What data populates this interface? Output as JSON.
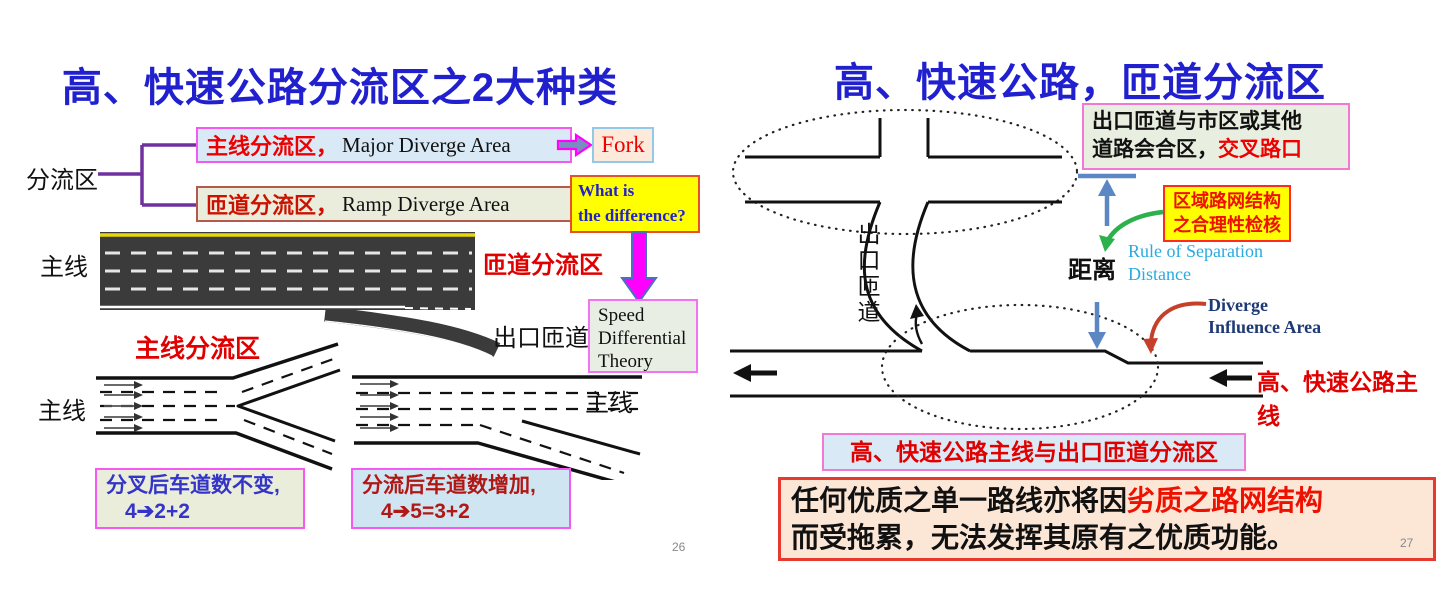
{
  "palette": {
    "title_blue": "#2020cf",
    "red_text": "#ee0000",
    "dark_red_text": "#b01815",
    "magenta_border": "#f459f4",
    "steel_blue_arrow": "#5b87c5",
    "green_arrow": "#2eb14d",
    "red_arrow": "#c5402b",
    "road_dark": "#3b3b3b",
    "yellow_box": "#ffff00"
  },
  "left_slide": {
    "title": "高、快速公路分流区之2大种类",
    "page_number": "26",
    "tree": {
      "root_label": "分流区",
      "major_cn": "主线分流区，",
      "major_en": "Major Diverge Area",
      "ramp_cn": "匝道分流区，",
      "ramp_en": "Ramp Diverge Area",
      "fork_label": "Fork",
      "question": "What is\nthe difference?"
    },
    "road_photo": {
      "mainline_label": "主线",
      "ramp_diverge_label": "匝道分流区",
      "exit_ramp_label": "出口匝道"
    },
    "theory_box": "Speed\nDifferential\nTheory",
    "diagrams": {
      "major_diverge_label": "主线分流区",
      "mainline_left": "主线",
      "mainline_right": "主线",
      "caption_fork_line1": "分叉后车道数不变,",
      "caption_fork_line2": "4➔2+2",
      "caption_diverge_line1": "分流后车道数增加,",
      "caption_diverge_line2": "4➔5=3+2"
    }
  },
  "right_slide": {
    "title": "高、快速公路，匝道分流区",
    "page_number": "27",
    "junction_box_black": "出口匝道与市区或其他\n道路会合区，",
    "junction_box_red": "交叉路口",
    "network_box": "区域路网结构\n之合理性检核",
    "distance_label": "距离",
    "rule_label": "Rule of Separation\nDistance",
    "diverge_influence_label": "Diverge\nInfluence Area",
    "exit_ramp_vertical": "出口匝道",
    "mainline_label": "高、快速公路主线",
    "diverge_caption": "高、快速公路主线与出口匝道分流区",
    "statement_black1": "任何优质之单一路线亦将因",
    "statement_red": "劣质之路网结构",
    "statement_black2": "\n而受拖累，无法发挥其原有之优质功能。"
  }
}
